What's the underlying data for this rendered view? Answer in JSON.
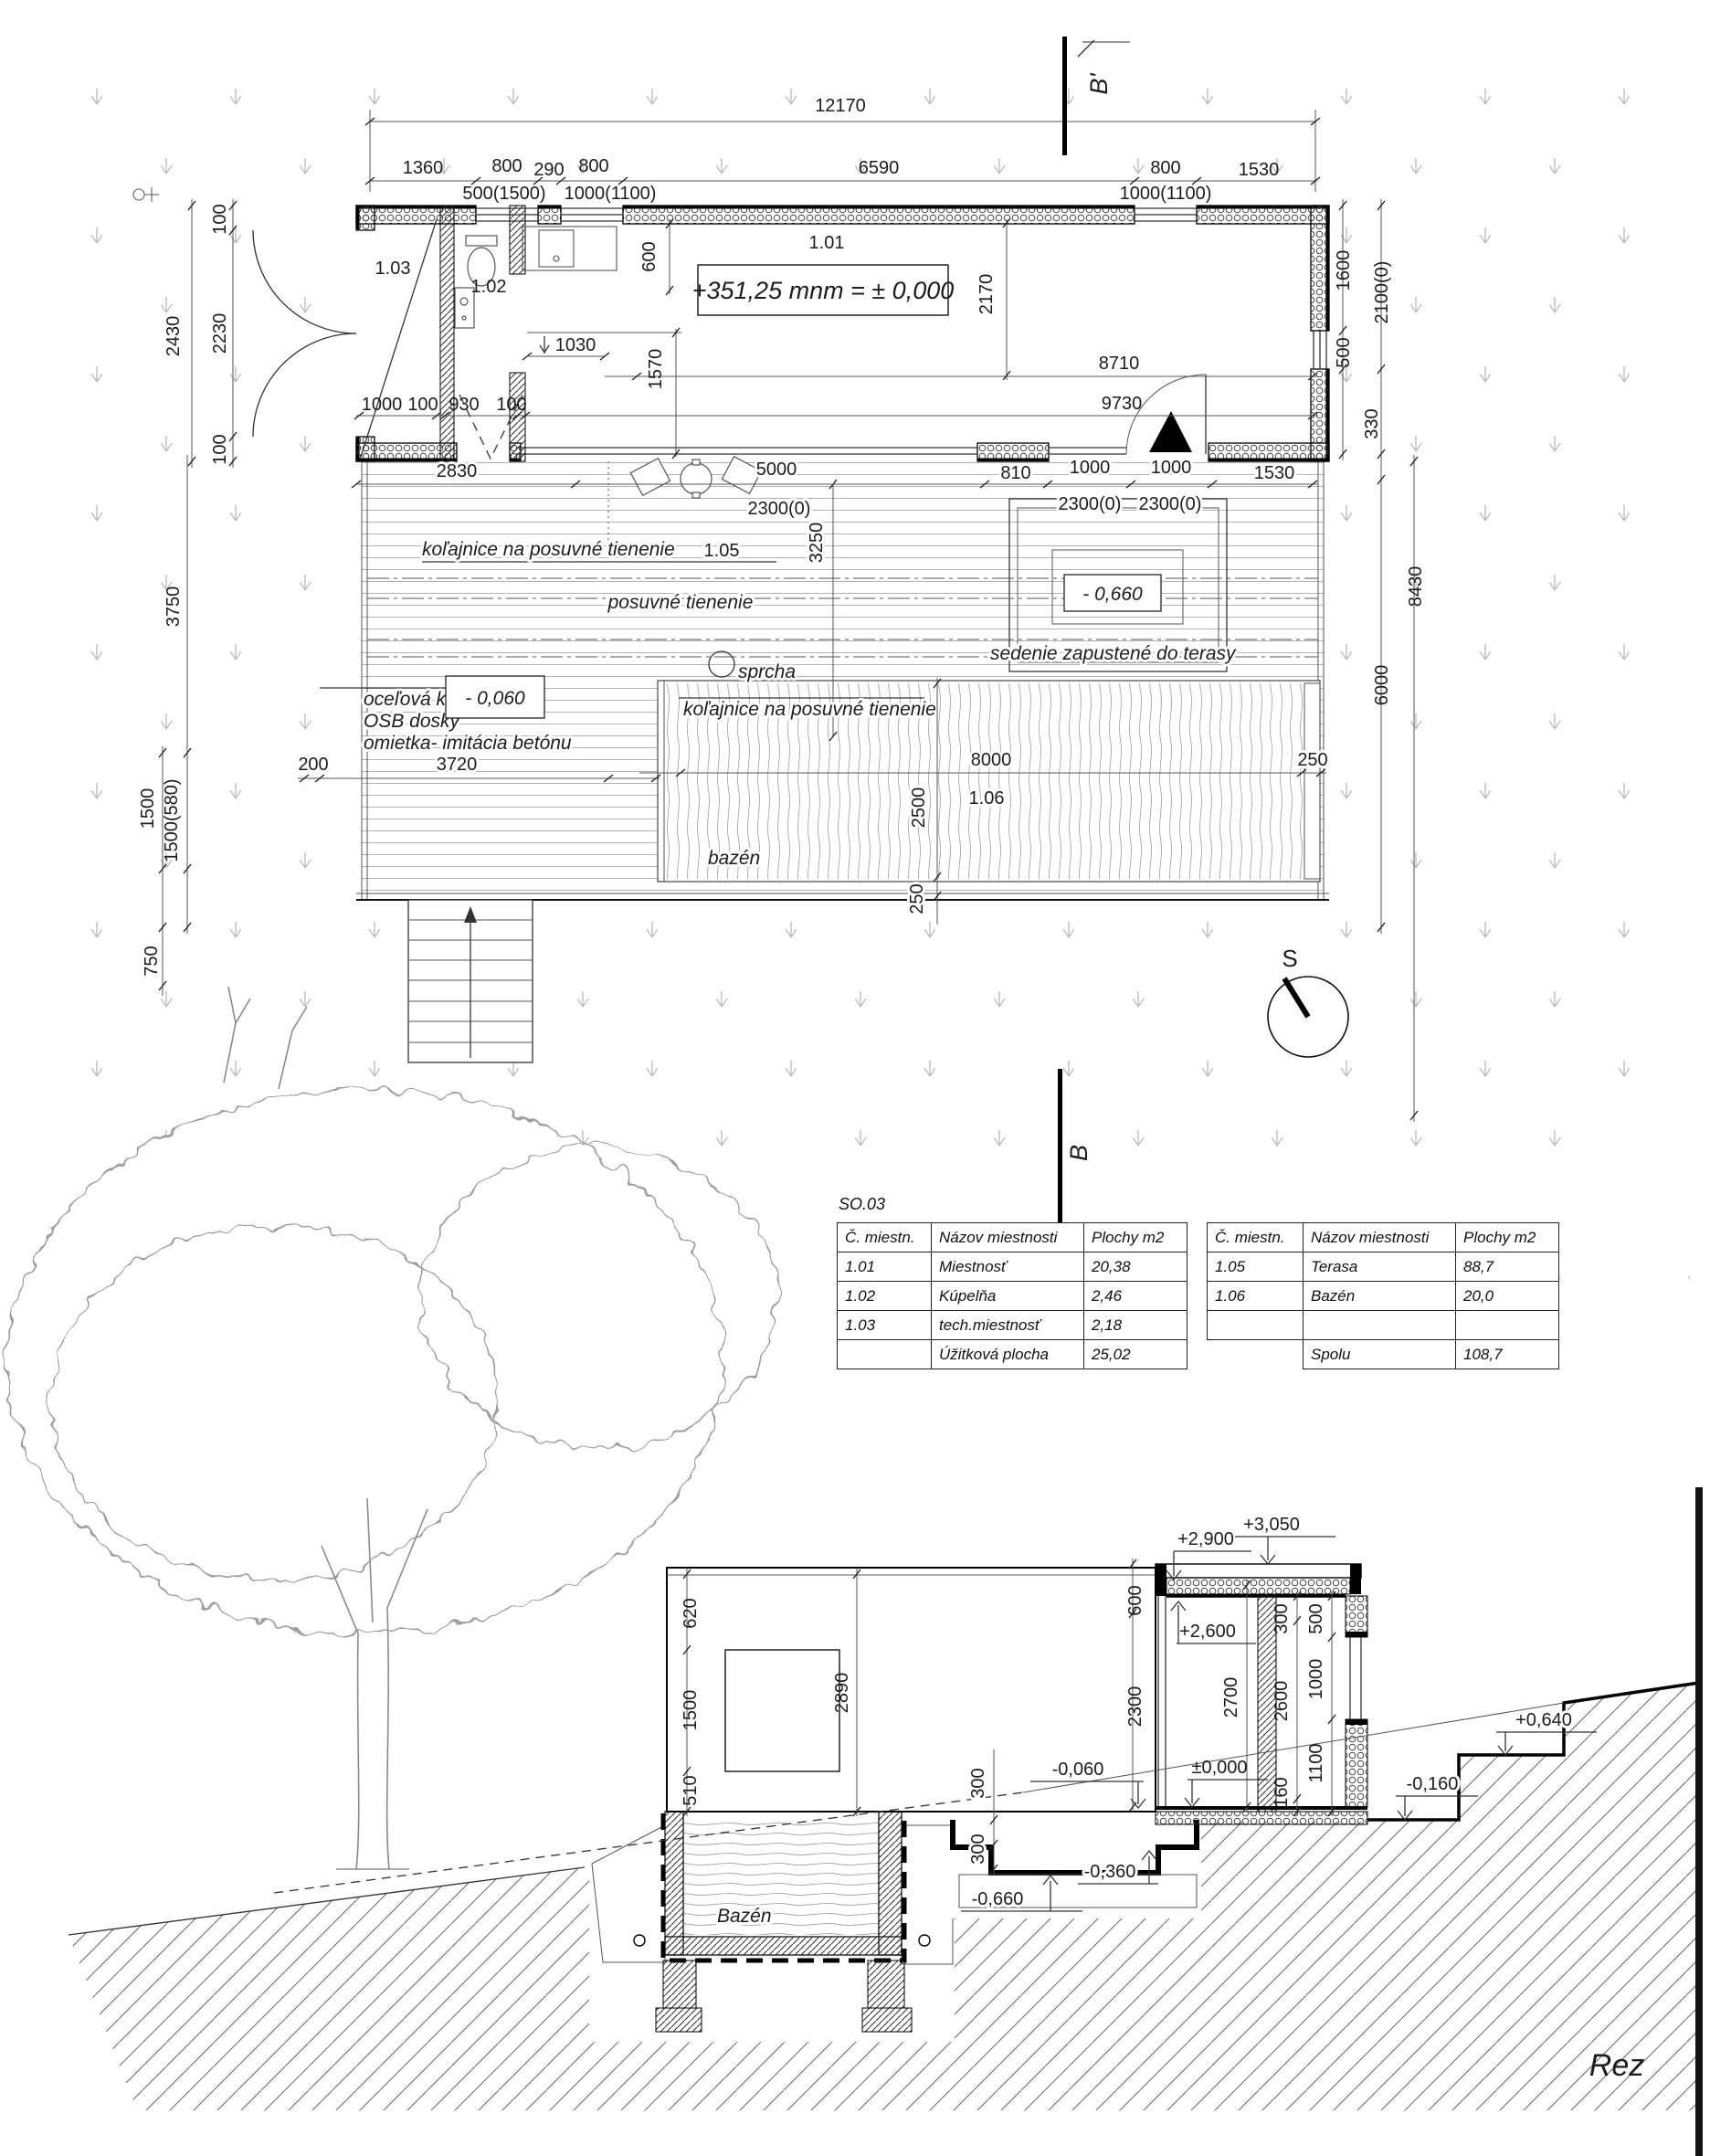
{
  "plan": {
    "cut_top": "B'",
    "cut_bottom": "B",
    "compass": "S",
    "dims_top": {
      "overall": "12170",
      "s1": "1360",
      "s2": "800",
      "s3": "290",
      "s4": "800",
      "s5": "6590",
      "s6": "800",
      "s7": "1530",
      "w1": "500(1500)",
      "w2": "1000(1100)",
      "w3": "1000(1100)"
    },
    "dims_left": {
      "a": "100",
      "b": "2230",
      "c": "100",
      "total": "2430",
      "d": "3750",
      "e": "1500",
      "f": "1500(580)",
      "g": "750"
    },
    "dims_right": {
      "a": "1600",
      "b": "500",
      "c": "2100(0)",
      "d": "330",
      "e": "8430",
      "f": "6000"
    },
    "house": {
      "r101": "1.01",
      "r102": "1.02",
      "r103": "1.03",
      "level_note": "+351,25 mnm = ± 0,000",
      "d600": "600",
      "d2170": "2170",
      "d1030": "1030",
      "d1570": "1570",
      "d8710": "8710",
      "d9730": "9730",
      "w1000": "1000",
      "w100a": "100",
      "w930": "930",
      "w100b": "100"
    },
    "terrace": {
      "r105": "1.05",
      "d2830": "2830",
      "d5000": "5000",
      "d2300a": "2300(0)",
      "d2300b": "2300(0)",
      "d2300c": "2300(0)",
      "rail1": "koľajnice na posuvné tienenie",
      "rail2": "koľajnice na posuvné tienenie",
      "shading": "posuvné tienenie",
      "d3250": "3250",
      "shower": "sprcha",
      "lvl1": "- 0,060",
      "lvl2": "- 0,660",
      "seat": "sedenie zapustené do terasy",
      "mat1": "oceľová konštrukcia",
      "mat2": "OSB dosky",
      "mat3": "omietka- imitácia betónu",
      "d200": "200",
      "d3720": "3720",
      "d810": "810",
      "d1000a": "1000",
      "d1000b": "1000",
      "d1530": "1530"
    },
    "pool": {
      "r106": "1.06",
      "name": "bazén",
      "d8000": "8000",
      "d2500": "2500",
      "d250a": "250",
      "d250b": "250"
    }
  },
  "tables": {
    "title": "SO.03",
    "headers": [
      "Č. miestn.",
      "Názov miestnosti",
      "Plochy m2"
    ],
    "left": {
      "rows": [
        [
          "1.01",
          "Miestnosť",
          "20,38"
        ],
        [
          "1.02",
          "Kúpelňa",
          "2,46"
        ],
        [
          "1.03",
          "tech.miestnosť",
          "2,18"
        ],
        [
          "",
          "Úžitková plocha",
          "25,02"
        ]
      ]
    },
    "right": {
      "rows": [
        [
          "1.05",
          "Terasa",
          "88,7"
        ],
        [
          "1.06",
          "Bazén",
          "20,0"
        ],
        [
          "",
          "",
          ""
        ],
        [
          "",
          "Spolu",
          "108,7"
        ]
      ]
    }
  },
  "section": {
    "levels": {
      "p3050": "+3,050",
      "p2900": "+2,900",
      "p2600": "+2,600",
      "zero": "±0,000",
      "m006": "-0,060",
      "m016": "-0,160",
      "m036": "-0,360",
      "m066": "-0,660",
      "p064": "+0,640"
    },
    "dims": {
      "d620": "620",
      "d1500": "1500",
      "d510": "510",
      "d2890": "2890",
      "d600": "600",
      "d2300": "2300",
      "d2700": "2700",
      "d300a": "300",
      "d2600": "2600",
      "d160": "160",
      "d500": "500",
      "d1000": "1000",
      "d1100": "1100",
      "d300b": "300",
      "d300c": "300"
    },
    "pool_label": "Bazén",
    "title": "Rez"
  }
}
